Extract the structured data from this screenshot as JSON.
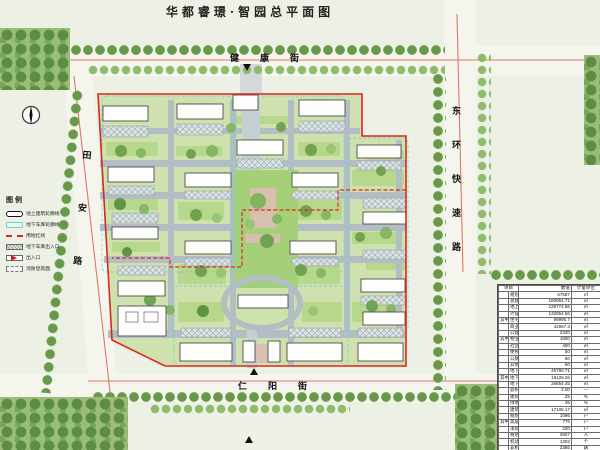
{
  "title": "华都睿璟·智园总平面图",
  "north_label": "北",
  "streets": {
    "top": "健康街",
    "right": "东环快速路",
    "left": "田安路",
    "bottom": "仁阳街"
  },
  "legend": {
    "title": "图例",
    "items": [
      "地上建筑轮廓线",
      "地下车库轮廓线",
      "用地红线",
      "地下车库出入口",
      "出入口",
      "消防登高面"
    ]
  },
  "table": {
    "headers": [
      "项目",
      "数值",
      "计量单位"
    ],
    "rows": [
      {
        "g": "",
        "label": "规划净用地面积",
        "value": "67587",
        "unit": "㎡"
      },
      {
        "g": "",
        "label": "总建筑面积",
        "value": "180954.71",
        "unit": "㎡"
      },
      {
        "g": "",
        "label": "地上总建筑面积",
        "value": "129774.56",
        "unit": "㎡"
      },
      {
        "g": "",
        "label": "计容总建筑面积",
        "value": "132854.56",
        "unit": "㎡"
      },
      {
        "g": "其中",
        "label": "住宅建筑面积",
        "value": "99996.7",
        "unit": "㎡"
      },
      {
        "g": "",
        "label": "商业建筑面积",
        "value": "42967.3",
        "unit": "㎡"
      },
      {
        "g": "",
        "label": "公建配套建筑面积",
        "value": "2320",
        "unit": "㎡"
      },
      {
        "g": "其中",
        "label": "物业管理用房面积",
        "value": "1800",
        "unit": "㎡"
      },
      {
        "g": "",
        "label": "社区管理用房面积",
        "value": "400",
        "unit": "㎡"
      },
      {
        "g": "",
        "label": "便民店建筑面积",
        "value": "50",
        "unit": "㎡"
      },
      {
        "g": "",
        "label": "公厕建筑面积",
        "value": "50",
        "unit": "㎡"
      },
      {
        "g": "",
        "label": "其他配套建筑面积",
        "value": "60",
        "unit": "㎡"
      },
      {
        "g": "",
        "label": "地下总建筑面积",
        "value": "45780.71",
        "unit": "㎡"
      },
      {
        "g": "其中",
        "label": "地下车库建筑面积",
        "value": "19126.26",
        "unit": "㎡"
      },
      {
        "g": "",
        "label": "地下人防建筑面积",
        "value": "26654.45",
        "unit": "㎡"
      },
      {
        "g": "",
        "label": "容积率",
        "value": "2.00",
        "unit": "—"
      },
      {
        "g": "",
        "label": "建筑密度",
        "value": "25",
        "unit": "%"
      },
      {
        "g": "",
        "label": "绿地率",
        "value": "35",
        "unit": "%"
      },
      {
        "g": "",
        "label": "建筑占地面积",
        "value": "17108.17",
        "unit": "㎡"
      },
      {
        "g": "",
        "label": "规划总户数",
        "value": "1096",
        "unit": "户"
      },
      {
        "g": "其中",
        "label": "高层户数",
        "value": "776",
        "unit": "户"
      },
      {
        "g": "",
        "label": "洋房户数",
        "value": "320",
        "unit": "户"
      },
      {
        "g": "",
        "label": "规划居住人数",
        "value": "2507",
        "unit": "人"
      },
      {
        "g": "",
        "label": "机动车停车位",
        "value": "1302",
        "unit": "个"
      },
      {
        "g": "",
        "label": "非机动车停车位",
        "value": "2366",
        "unit": "辆"
      }
    ]
  }
}
